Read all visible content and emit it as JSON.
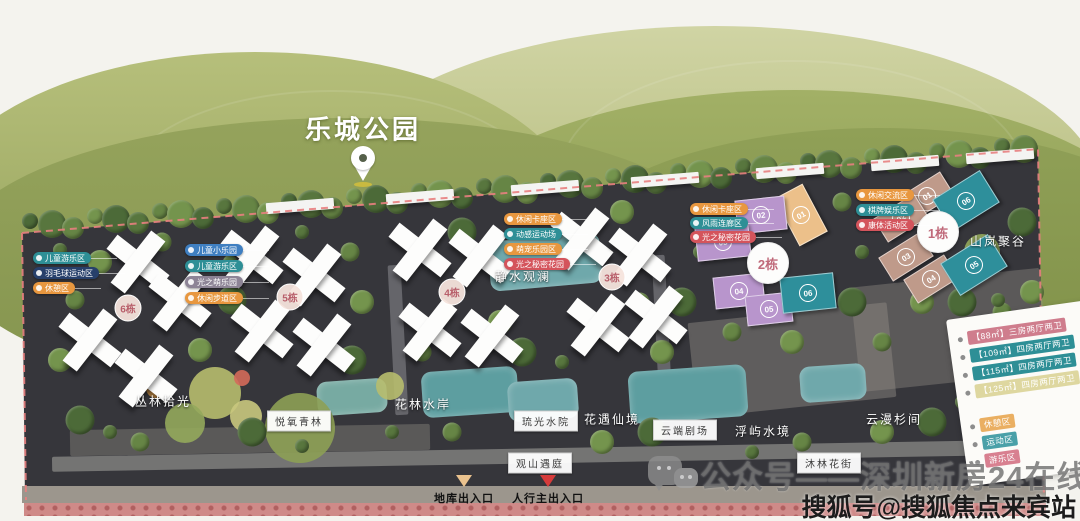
{
  "park": {
    "label": "乐城公园"
  },
  "site": {
    "area_labels": [
      {
        "text": "静水观澜",
        "x": 523,
        "y": 276,
        "style": "plain"
      },
      {
        "text": "丛林拾光",
        "x": 163,
        "y": 401,
        "style": "plain"
      },
      {
        "text": "花林水岸",
        "x": 423,
        "y": 404,
        "style": "plain"
      },
      {
        "text": "花遇仙境",
        "x": 612,
        "y": 419,
        "style": "plain"
      },
      {
        "text": "浮屿水境",
        "x": 763,
        "y": 431,
        "style": "plain"
      },
      {
        "text": "云漫杉间",
        "x": 894,
        "y": 419,
        "style": "plain"
      },
      {
        "text": "山岚聚谷",
        "x": 998,
        "y": 241,
        "style": "plain"
      },
      {
        "text": "悦氧青林",
        "x": 299,
        "y": 421,
        "style": "boxed"
      },
      {
        "text": "琉光水院",
        "x": 546,
        "y": 421,
        "style": "boxed"
      },
      {
        "text": "云端剧场",
        "x": 685,
        "y": 430,
        "style": "boxed"
      },
      {
        "text": "观山遇庭",
        "x": 540,
        "y": 463,
        "style": "boxed"
      },
      {
        "text": "沐林花街",
        "x": 829,
        "y": 463,
        "style": "boxed"
      }
    ],
    "building_badges": [
      {
        "label": "6栋",
        "x": 128,
        "y": 308
      },
      {
        "label": "5栋",
        "x": 290,
        "y": 297
      },
      {
        "label": "4栋",
        "x": 452,
        "y": 292
      },
      {
        "label": "3栋",
        "x": 612,
        "y": 277
      }
    ],
    "wing_buildings": [
      {
        "badge": "2栋",
        "x": 768,
        "y": 263,
        "wings": [
          {
            "num": "01",
            "color": "#ecc08a",
            "x": 801,
            "y": 215,
            "w": 30,
            "h": 52,
            "rot": -28
          },
          {
            "num": "02",
            "color": "#b895cc",
            "x": 761,
            "y": 215,
            "w": 48,
            "h": 32,
            "rot": -6
          },
          {
            "num": "03",
            "color": "#b895cc",
            "x": 723,
            "y": 242,
            "w": 52,
            "h": 32,
            "rot": -6
          },
          {
            "num": "04",
            "color": "#b895cc",
            "x": 739,
            "y": 291,
            "w": 48,
            "h": 30,
            "rot": -6
          },
          {
            "num": "05",
            "color": "#b895cc",
            "x": 769,
            "y": 309,
            "w": 44,
            "h": 28,
            "rot": -6
          },
          {
            "num": "06",
            "color": "#2e8f9b",
            "x": 808,
            "y": 293,
            "w": 52,
            "h": 34,
            "rot": -6
          }
        ]
      },
      {
        "badge": "1栋",
        "x": 938,
        "y": 232,
        "wings": [
          {
            "num": "01",
            "color": "#bf9a8a",
            "x": 927,
            "y": 196,
            "w": 46,
            "h": 26,
            "rot": -32
          },
          {
            "num": "02",
            "color": "#bf9a8a",
            "x": 901,
            "y": 218,
            "w": 46,
            "h": 26,
            "rot": -32
          },
          {
            "num": "03",
            "color": "#bf9a8a",
            "x": 906,
            "y": 257,
            "w": 46,
            "h": 26,
            "rot": -32
          },
          {
            "num": "04",
            "color": "#bf9a8a",
            "x": 931,
            "y": 279,
            "w": 46,
            "h": 26,
            "rot": -32
          },
          {
            "num": "05",
            "color": "#2e8f9b",
            "x": 974,
            "y": 265,
            "w": 54,
            "h": 36,
            "rot": -32
          },
          {
            "num": "06",
            "color": "#2e8f9b",
            "x": 966,
            "y": 201,
            "w": 54,
            "h": 36,
            "rot": -32
          }
        ]
      }
    ],
    "pill_groups": [
      {
        "x": 33,
        "y": 252,
        "step": 15,
        "items": [
          {
            "text": "儿童游乐区",
            "color": "#2e8f96"
          },
          {
            "text": "羽毛球运动区",
            "color": "#27406b"
          },
          {
            "text": "休憩区",
            "color": "#e8973f"
          }
        ]
      },
      {
        "x": 185,
        "y": 244,
        "step": 16,
        "items": [
          {
            "text": "儿童小乐园",
            "color": "#3f7fc1"
          },
          {
            "text": "儿童游乐区",
            "color": "#2e8f96"
          },
          {
            "text": "光之萌乐园",
            "color": "#8d8496"
          },
          {
            "text": "休闲步道区",
            "color": "#e8973f"
          }
        ]
      },
      {
        "x": 504,
        "y": 213,
        "step": 15,
        "items": [
          {
            "text": "休闲卡座区",
            "color": "#e8973f"
          },
          {
            "text": "动感运动场",
            "color": "#2e8f96"
          },
          {
            "text": "萌宠乐园区",
            "color": "#e8973f"
          },
          {
            "text": "光之秘密花园",
            "color": "#d4545c"
          }
        ]
      },
      {
        "x": 690,
        "y": 203,
        "step": 14,
        "items": [
          {
            "text": "休闲卡座区",
            "color": "#e8973f"
          },
          {
            "text": "风雨连廊区",
            "color": "#2e8f96"
          },
          {
            "text": "光之秘密花园",
            "color": "#d4545c"
          }
        ]
      },
      {
        "x": 856,
        "y": 189,
        "step": 15,
        "items": [
          {
            "text": "休闲交流区",
            "color": "#e8973f"
          },
          {
            "text": "棋牌娱乐区",
            "color": "#2e8f96"
          },
          {
            "text": "康体活动区",
            "color": "#d4545c"
          }
        ]
      }
    ],
    "entrances": [
      {
        "label": "地库出入口",
        "tri": "#eac28e",
        "x": 464,
        "y": 475
      },
      {
        "label": "人行主出入口",
        "tri": "#d63b3b",
        "x": 548,
        "y": 475
      }
    ]
  },
  "legend_card": {
    "units": [
      {
        "text": "【88㎡】三房两厅两卫",
        "bg": "#cf7d8d"
      },
      {
        "text": "【109㎡】四房两厅两卫",
        "bg": "#2e8f96"
      },
      {
        "text": "【115㎡】四房两厅两卫",
        "bg": "#2e8f96"
      },
      {
        "text": "【125㎡】四房两厅两卫",
        "bg": "#ded7a0"
      }
    ],
    "amenities": [
      {
        "text": "休憩区",
        "bg": "#eaaf62"
      },
      {
        "text": "运动区",
        "bg": "#4aa0a8"
      },
      {
        "text": "游乐区",
        "bg": "#d88090"
      }
    ]
  },
  "watermarks": {
    "wechat": "公众号——深圳新房24在线",
    "sohu": "搜狐号@搜狐焦点来宾站"
  },
  "colors": {
    "boundary_dash": "#e87f7f",
    "hill_green": "#8f9d55",
    "ground_dark": "#36363b",
    "water_teal": "#5d9ea0"
  }
}
